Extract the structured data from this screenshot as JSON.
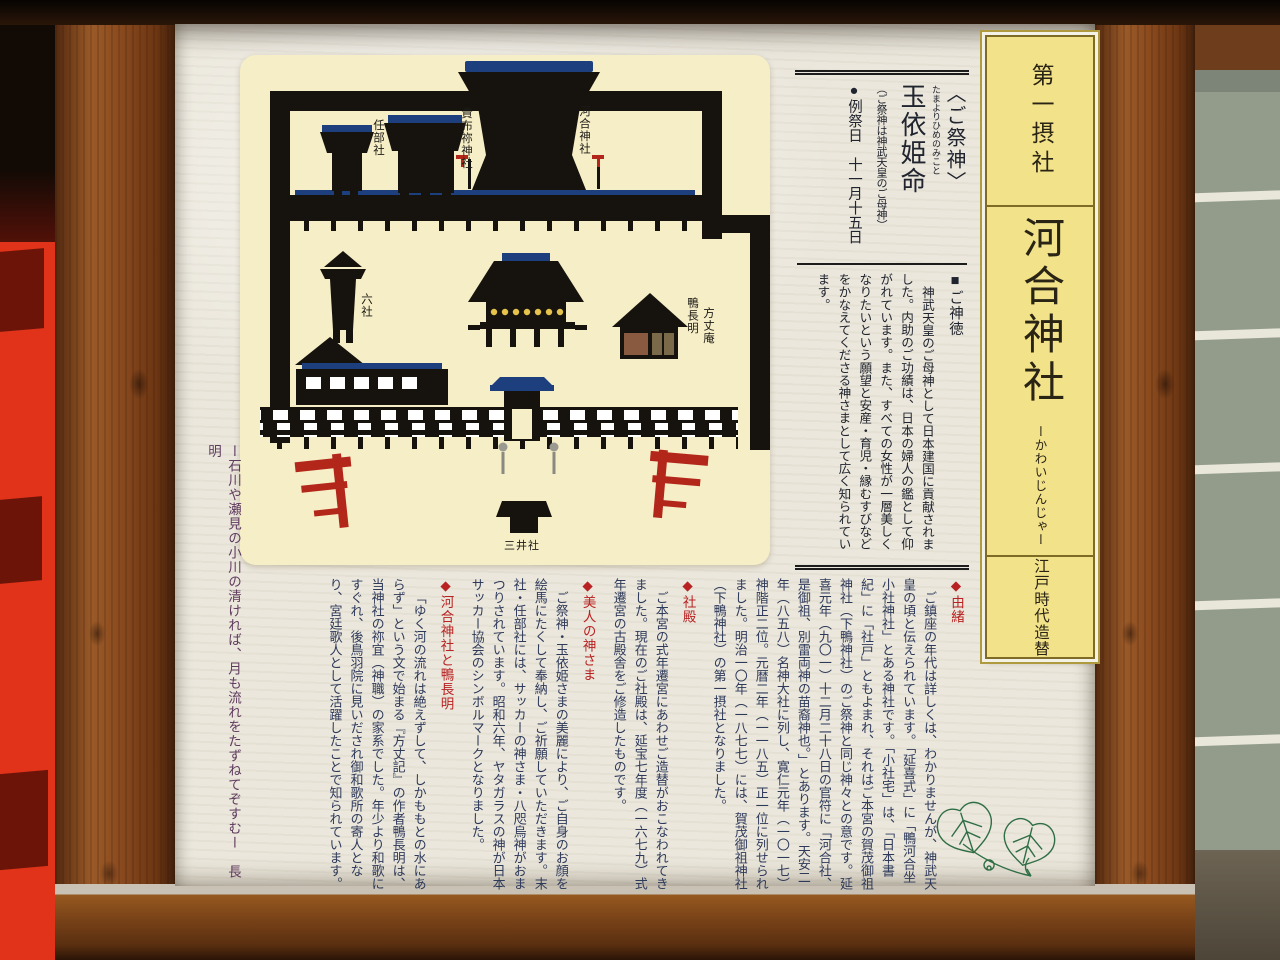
{
  "banner": {
    "rank": "第一摂社",
    "title": "河合神社",
    "furigana": "ーかわいじんじゃー",
    "era_note": "江戸時代造替"
  },
  "deity_header": {
    "bracket_title": "〈ご祭神〉",
    "deity_name": "玉依姫命",
    "deity_furigana": "たまよりひめのみこと",
    "deity_note": "（ご祭神は神武天皇のご母神）",
    "festival": "●例祭日　十一月十五日"
  },
  "shintoku": {
    "heading": "■ご神徳",
    "body": "神武天皇のご母神として日本建国に貢献されました。内助のご功績は、日本の婦人の鑑として仰がれています。また、すべての女性が一層美しくなりたいという願望と安産・育児・縁むすびなどをかなえてくださる神さまとして広く知られています。"
  },
  "map_labels": {
    "ninbesha": "任部社",
    "kifune": "貴布祢神社",
    "kawai": "河合神社",
    "rokusha": "六社",
    "chomei_1": "鴨長明",
    "chomei_2": "方丈庵",
    "mitsuisha": "三井社"
  },
  "sections": [
    {
      "heading": "◆由緒",
      "body": "ご鎮座の年代は詳しくは、わかりませんが、神武天皇の頃と伝えられています。「延喜式」に「鴨河合坐小社神社」とある神社です。「小社宅」は、「日本書紀」に「社戸」ともよまれ、それはご本宮の賀茂御祖神社（下鴨神社）のご祭神と同じ神々との意です。延喜元年（九〇一）十二月二十八日の官符に「河合社、是御祖、別雷両神の苗裔神也。」とあります。天安二年（八五八）名神大社に列し、寛仁元年（一〇一七）神階正二位。元暦二年（一一八五）正一位に列せられました。明治一〇年（一八七七）には、賀茂御祖神社（下鴨神社）の第一摂社となりました。"
    },
    {
      "heading": "◆社殿",
      "body": "ご本宮の式年遷宮にあわせご造替がおこなわれてきました。現在のご社殿は、延宝七年度（一六七九）式年遷宮の古殿舎をご修造したものです。"
    },
    {
      "heading": "◆美人の神さま",
      "body": "ご祭神・玉依姫さまの美麗により、ご自身のお顔を絵馬にたくして奉納し、ご祈願していただきます。末社・任部社には、サッカーの神さま・八咫烏神がおまつりされています。昭和六年、ヤタガラスの神が日本サッカー協会のシンボルマークとなりました。"
    },
    {
      "heading": "◆河合神社と鴨長明",
      "body": "「ゆく河の流れは絶えずして、しかももとの水にあらず」という文で始まる『方丈記』の作者鴨長明は、当神社の祢宜（神職）の家系でした。年少より和歌にすぐれ、後鳥羽院に見いだされ御和歌所の寄人となり、宮廷歌人として活躍したことで知られています。"
    }
  ],
  "poem": "ー石川や瀬見の小川の清ければ、月も流れをたずねてぞすむー　長明",
  "colors": {
    "paper": "#ebe7dc",
    "map_panel_bg": "#f6eec6",
    "banner_bg": "#f2e289",
    "heading_red": "#b92222",
    "body_navy": "#2e3a5a",
    "torii_red": "#b3261a",
    "fence_vermillion": "#e0331a",
    "roof_blue": "#1e3f7d",
    "lantern_yellow": "#e6c34a",
    "leaf_green": "#2f6e45"
  }
}
